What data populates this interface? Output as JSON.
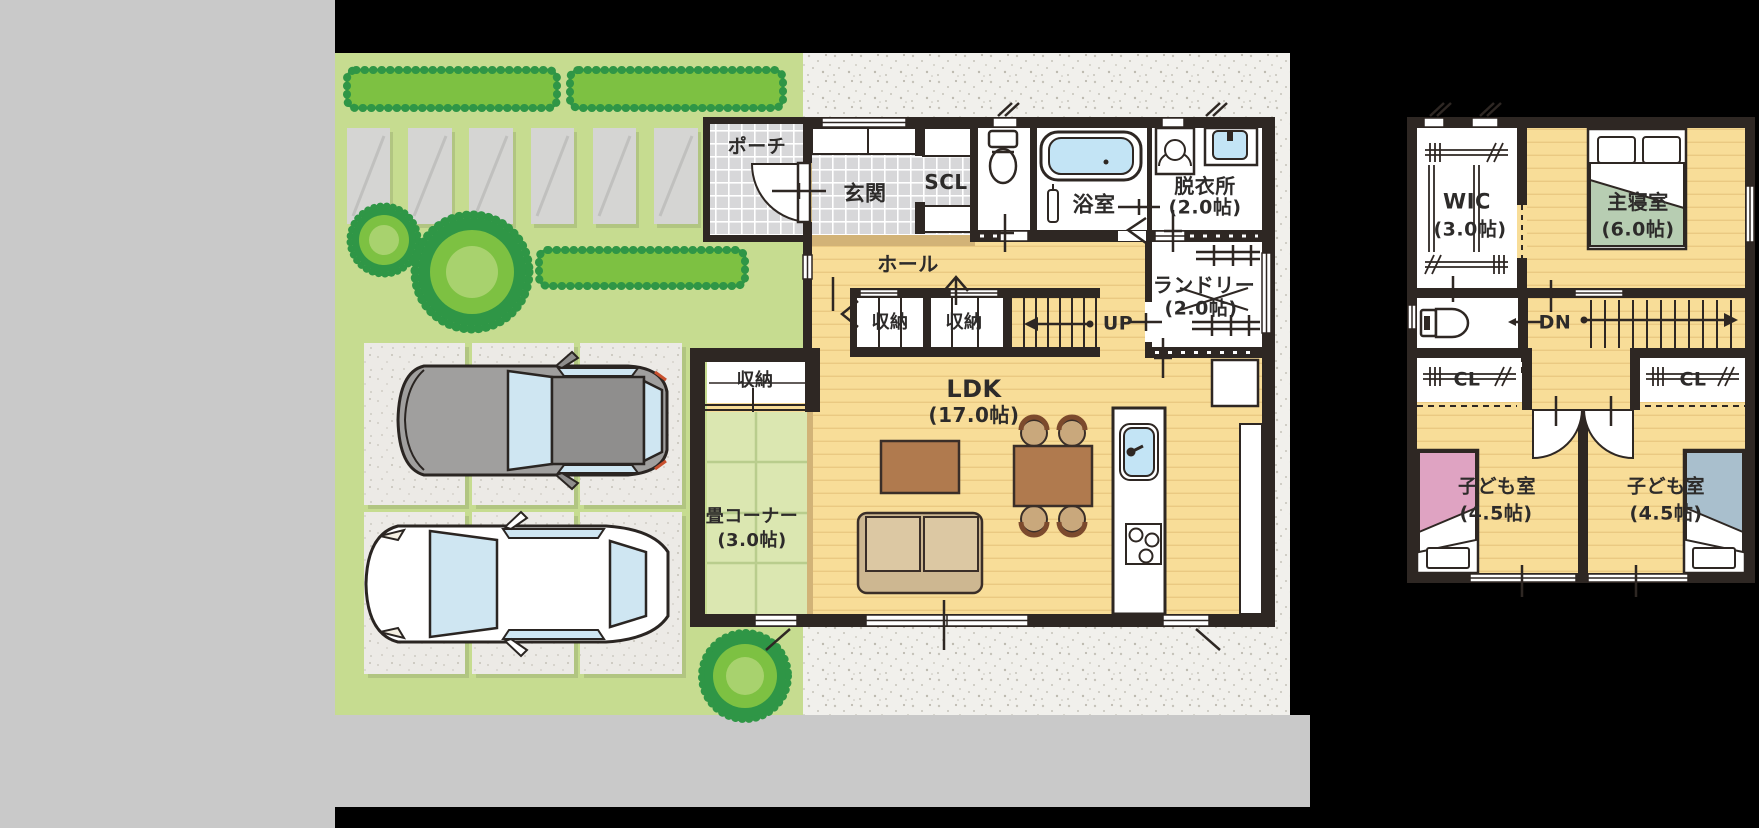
{
  "colors": {
    "background": "#000000",
    "panel_gray": "#c9c9c9",
    "lawn_green": "#c6dc90",
    "hedge_green": "#7dc142",
    "hedge_edge_green": "#2f9646",
    "tree_core_green": "#a8d26e",
    "concrete_white": "#f1f0ec",
    "wall_dark": "#2e2723",
    "wood_floor": "#f8dd98",
    "tile_gray": "#d7d7d9",
    "tatami_green": "#dbe7b1",
    "threshold_tan": "#d2b377",
    "water_blue": "#c3e4f5",
    "bed_green": "#b7cdb2",
    "bed_pink": "#dfa3c2",
    "bed_blue": "#a9bfcd",
    "sofa_tan": "#cdb791",
    "table_brown": "#b07a4e",
    "text": "#2d2b2a"
  },
  "floor1": {
    "labels": {
      "porch": "ポーチ",
      "entrance": "玄関",
      "shoe_closet": "SCL",
      "bathroom": "浴室",
      "changing_room": "脱衣所",
      "changing_room_size": "(2.0帖)",
      "hall": "ホール",
      "storage_a": "収納",
      "storage_b": "収納",
      "stairs_up": "UP",
      "laundry": "ランドリー",
      "laundry_size": "(2.0帖)",
      "storage_c": "収納",
      "ldk": "LDK",
      "ldk_size": "(17.0帖)",
      "tatami_corner": "畳コーナー",
      "tatami_corner_size": "(3.0帖)"
    }
  },
  "floor2": {
    "labels": {
      "wic": "WIC",
      "wic_size": "(3.0帖)",
      "master_bedroom": "主寝室",
      "master_bedroom_size": "(6.0帖)",
      "stairs_down": "DN",
      "closet_left": "CL",
      "closet_right": "CL",
      "kids_room_left": "子ども室",
      "kids_room_left_size": "(4.5帖)",
      "kids_room_right": "子ども室",
      "kids_room_right_size": "(4.5帖)"
    }
  }
}
